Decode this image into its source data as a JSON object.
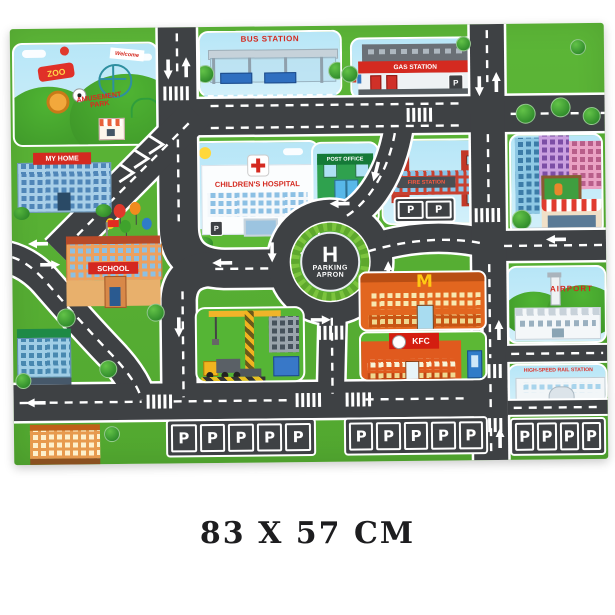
{
  "product": {
    "caption": "83 X 57 CM"
  },
  "mat": {
    "colors": {
      "road": "#3e4144",
      "grass": "#58b133",
      "sky": "#b7e6f7",
      "sign_red": "#d42a20",
      "curb": "#ffffff",
      "roundabout_green": "#7cc43e"
    },
    "labels": {
      "zoo": "ZOO",
      "welcome": "Welcome",
      "amusement_park": "AMUSEMENT PARK",
      "my_home": "MY HOME",
      "bus_station": "BUS STATION",
      "gas_station": "GAS STATION",
      "post_office": "POST OFFICE",
      "children_hospital": "CHILDREN'S HOSPITAL",
      "fire_station": "FIRE STATION",
      "school": "SCHOOL",
      "helipad": "H",
      "parking_line1": "PARKING",
      "parking_line2": "APRON",
      "mcdonalds_m": "M",
      "kfc": "KFC",
      "airport": "AIRPORT",
      "rail_station": "HIGH-SPEED RAIL STATION",
      "parking_p": "P"
    }
  }
}
